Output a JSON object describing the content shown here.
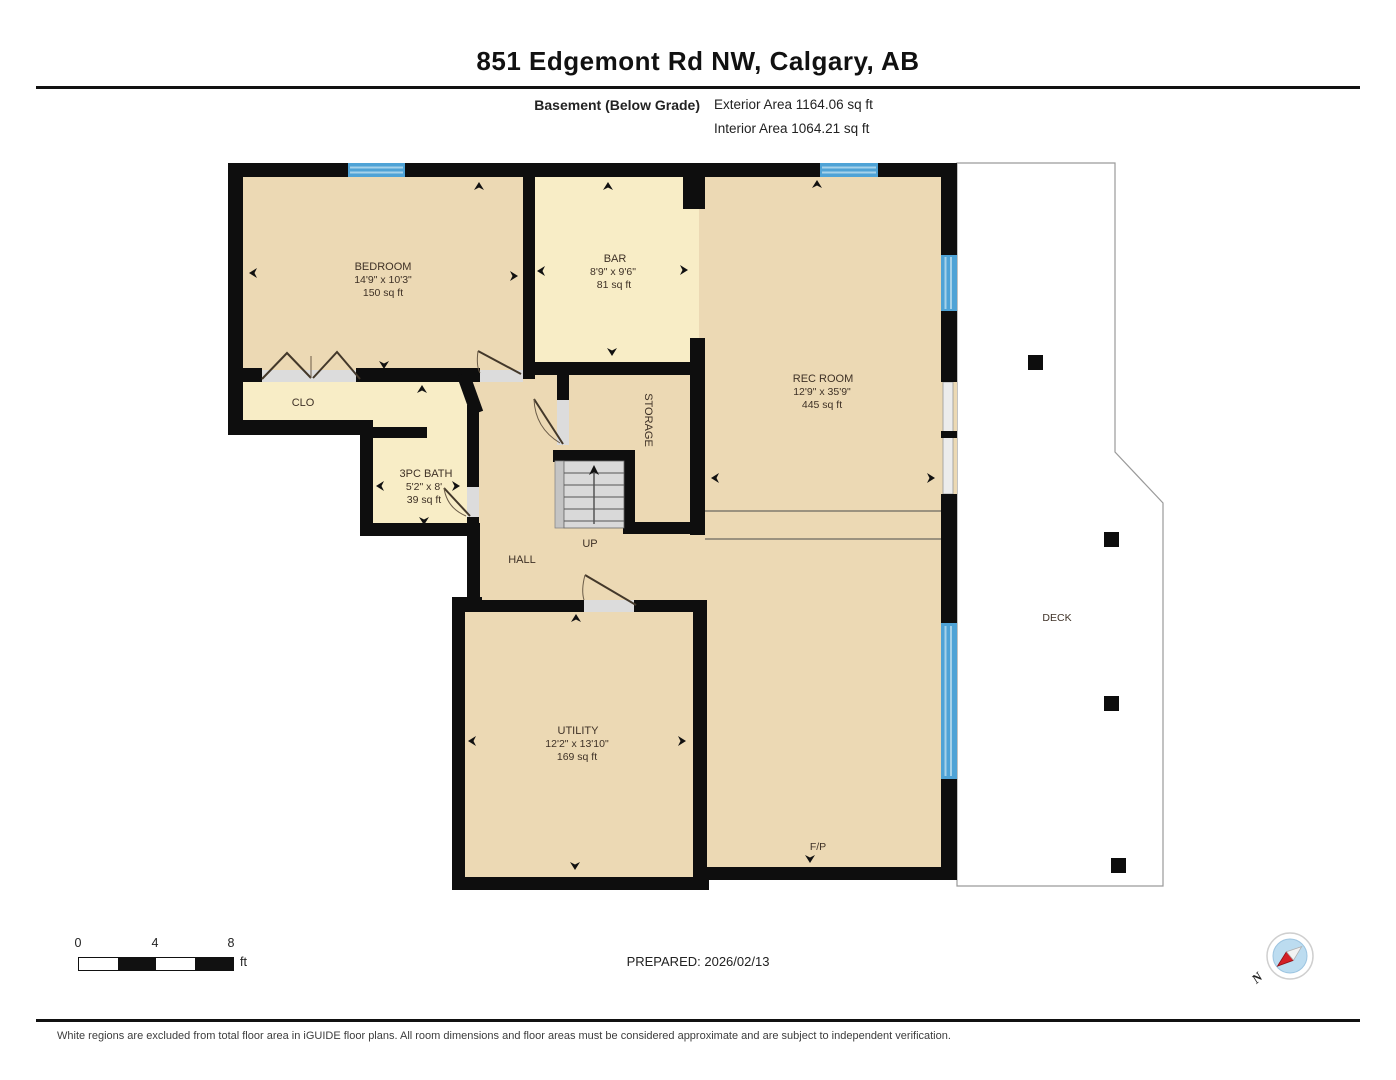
{
  "header": {
    "title": "851 Edgemont Rd NW, Calgary, AB",
    "floor_label": "Basement (Below Grade)",
    "exterior_area": "Exterior Area 1164.06 sq ft",
    "interior_area": "Interior Area 1064.21 sq ft"
  },
  "rooms": {
    "bedroom": {
      "name": "BEDROOM",
      "dims": "14'9\" x 10'3\"",
      "area": "150 sq ft"
    },
    "bar": {
      "name": "BAR",
      "dims": "8'9\" x 9'6\"",
      "area": "81 sq ft"
    },
    "rec_room": {
      "name": "REC ROOM",
      "dims": "12'9\" x 35'9\"",
      "area": "445 sq ft"
    },
    "closet": {
      "name": "CLO"
    },
    "bath": {
      "name": "3PC BATH",
      "dims": "5'2\" x 8'",
      "area": "39 sq ft"
    },
    "storage": {
      "name": "STORAGE"
    },
    "hall": {
      "name": "HALL"
    },
    "stairs": {
      "name": "UP"
    },
    "utility": {
      "name": "UTILITY",
      "dims": "12'2\" x 13'10\"",
      "area": "169 sq ft"
    },
    "deck": {
      "name": "DECK"
    },
    "fireplace": {
      "name": "F/P"
    }
  },
  "scale_bar": {
    "tick_0": "0",
    "tick_4": "4",
    "tick_8": "8",
    "unit": "ft"
  },
  "prepared_label": "PREPARED: 2026/02/13",
  "compass": {
    "north_label": "N"
  },
  "footer_note": "White regions are excluded from total floor area in iGUIDE floor plans. All room dimensions and floor areas must be considered approximate and are subject to independent verification.",
  "colors": {
    "floor-tan": "#ecd9b4",
    "floor-yellow": "#f8edc6",
    "wall": "#0e0e0e",
    "window-blue": "#4fa3d6",
    "window-stripe": "#a6d2ea",
    "label": "#3e3126",
    "deck-outline": "#9a9a9a"
  }
}
